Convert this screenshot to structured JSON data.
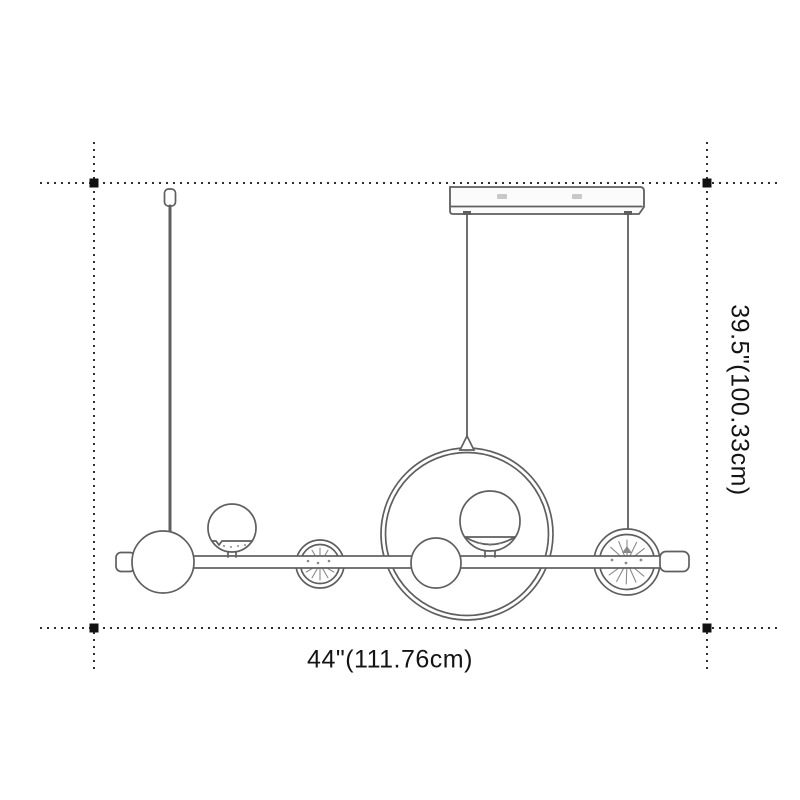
{
  "labels": {
    "width": "44\"(111.76cm)",
    "height": "39.5\"(100.33cm)"
  },
  "colors": {
    "background": "#ffffff",
    "line": "#5f5f5f",
    "line_light": "#8a8a8a",
    "dimension": "#2e2e2e",
    "marker": "#111111",
    "text": "#141414",
    "canopy_fill": "#fbfbfb",
    "screw": "#c8c8c8",
    "fill": "#ffffff"
  }
}
